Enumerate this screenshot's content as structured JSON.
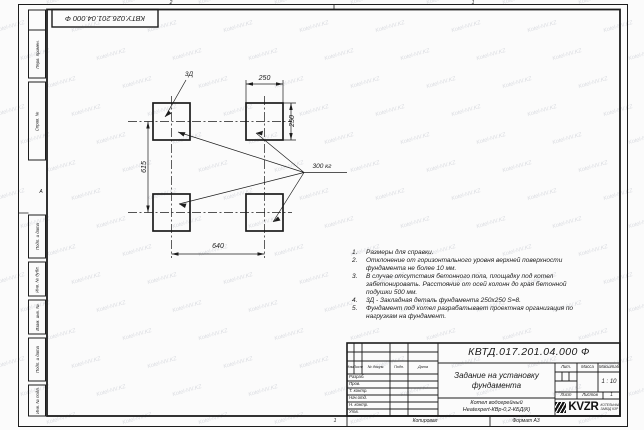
{
  "watermark": {
    "text": "Kotel-NV.KZ"
  },
  "stamp_top": {
    "text": "КВТУ.026.201.04.000 Ф"
  },
  "zones": {
    "top_left": "2",
    "top_right": "1",
    "left": "А",
    "bottom": "1"
  },
  "margin_labels": [
    "Перв. примен.",
    "Справ. №",
    "Подп. и дата",
    "Инв. № дубл.",
    "Взам. инв. №",
    "Подп. и дата",
    "Инв. № подл."
  ],
  "drawing": {
    "detail_label": "3Д",
    "load_label": "300 кг",
    "dim_top": "250",
    "dim_right": "250",
    "dim_left": "615",
    "dim_bottom": "640"
  },
  "notes": {
    "items": [
      {
        "num": "1.",
        "text": "Размеры для справки."
      },
      {
        "num": "2.",
        "text": "Отклонение от горизонтального уровня верхней поверхности фундамента не более 10 мм."
      },
      {
        "num": "3.",
        "text": "В случае отсутствия бетонного пола, площадку под котел забетонировать. Расстояние от осей колонн до края бетонной подушки 500 мм."
      },
      {
        "num": "4.",
        "text": "3Д - Закладная деталь фундамента 250х250 S=8."
      },
      {
        "num": "5.",
        "text": "Фундамент под котел разрабатывает проектная организация по нагрузкам на фундамент."
      }
    ]
  },
  "title_block": {
    "designation": "КВТД.017.201.04.000 Ф",
    "doc_title": "Задание на установку фундамента",
    "product_line1": "Котел водогрейный",
    "product_line2": "Heatexpert-КВр-0,2-КБД(К)",
    "header_cols": {
      "izm": "Изм.",
      "list": "Лист",
      "doc": "№ докум.",
      "podp": "Подп.",
      "data": "Дата"
    },
    "rows": [
      "Разраб.",
      "Пров.",
      "Т. контр.",
      "Нач.отд.",
      "Н. контр.",
      "Утв."
    ],
    "lit_label": "Лит.",
    "mass_label": "Масса",
    "scale_label": "Масштаб",
    "scale_value": "1 : 10",
    "sheet_label": "Лист",
    "sheets_label": "Листов",
    "sheets_value": "1",
    "logo": {
      "text": "KVZR",
      "sub1": "КОТЕЛЬНЫЙ",
      "sub2": "ЗАВОД КЗР"
    },
    "copied_label": "Копировал",
    "format_label": "Формат А3"
  }
}
